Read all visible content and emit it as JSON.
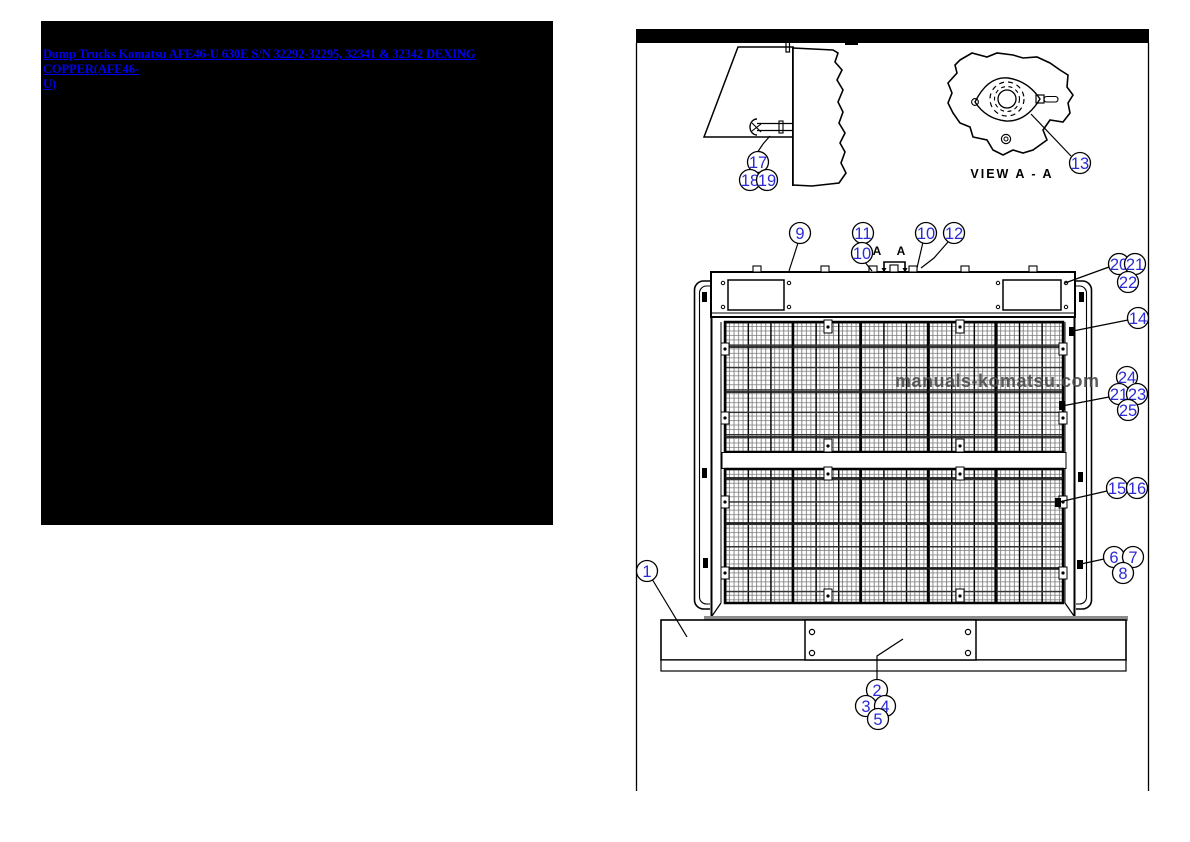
{
  "header_link": {
    "text": "Dump Trucks Komatsu AFE46-U 630E S/N 32292-32295, 32341 & 32342 DEXING COPPER(AFE46-\nU)",
    "color": "#0000EE"
  },
  "diagram": {
    "watermark": "manuals-komatsu.com",
    "view_label": "VIEW A - A",
    "section_letter": "A",
    "callout_color": "#2b2bd6",
    "callouts": [
      {
        "label": "1",
        "x": 647,
        "y": 571
      },
      {
        "label": "2",
        "x": 877,
        "y": 690
      },
      {
        "label": "3",
        "x": 866,
        "y": 706
      },
      {
        "label": "4",
        "x": 885,
        "y": 706
      },
      {
        "label": "5",
        "x": 878,
        "y": 719
      },
      {
        "label": "6",
        "x": 1114,
        "y": 557
      },
      {
        "label": "7",
        "x": 1133,
        "y": 557
      },
      {
        "label": "8",
        "x": 1123,
        "y": 573
      },
      {
        "label": "9",
        "x": 800,
        "y": 233
      },
      {
        "label": "11",
        "x": 863,
        "y": 233
      },
      {
        "label": "10",
        "x": 862,
        "y": 253
      },
      {
        "label": "10",
        "x": 926,
        "y": 233
      },
      {
        "label": "12",
        "x": 954,
        "y": 233
      },
      {
        "label": "13",
        "x": 1080,
        "y": 163
      },
      {
        "label": "14",
        "x": 1138,
        "y": 318
      },
      {
        "label": "15",
        "x": 1117,
        "y": 488
      },
      {
        "label": "16",
        "x": 1137,
        "y": 488
      },
      {
        "label": "17",
        "x": 758,
        "y": 162
      },
      {
        "label": "18",
        "x": 750,
        "y": 180
      },
      {
        "label": "19",
        "x": 767,
        "y": 180
      },
      {
        "label": "20",
        "x": 1119,
        "y": 264
      },
      {
        "label": "21",
        "x": 1135,
        "y": 264
      },
      {
        "label": "22",
        "x": 1128,
        "y": 282
      },
      {
        "label": "24",
        "x": 1127,
        "y": 377
      },
      {
        "label": "21",
        "x": 1119,
        "y": 394
      },
      {
        "label": "23",
        "x": 1137,
        "y": 394
      },
      {
        "label": "25",
        "x": 1128,
        "y": 410
      }
    ]
  }
}
